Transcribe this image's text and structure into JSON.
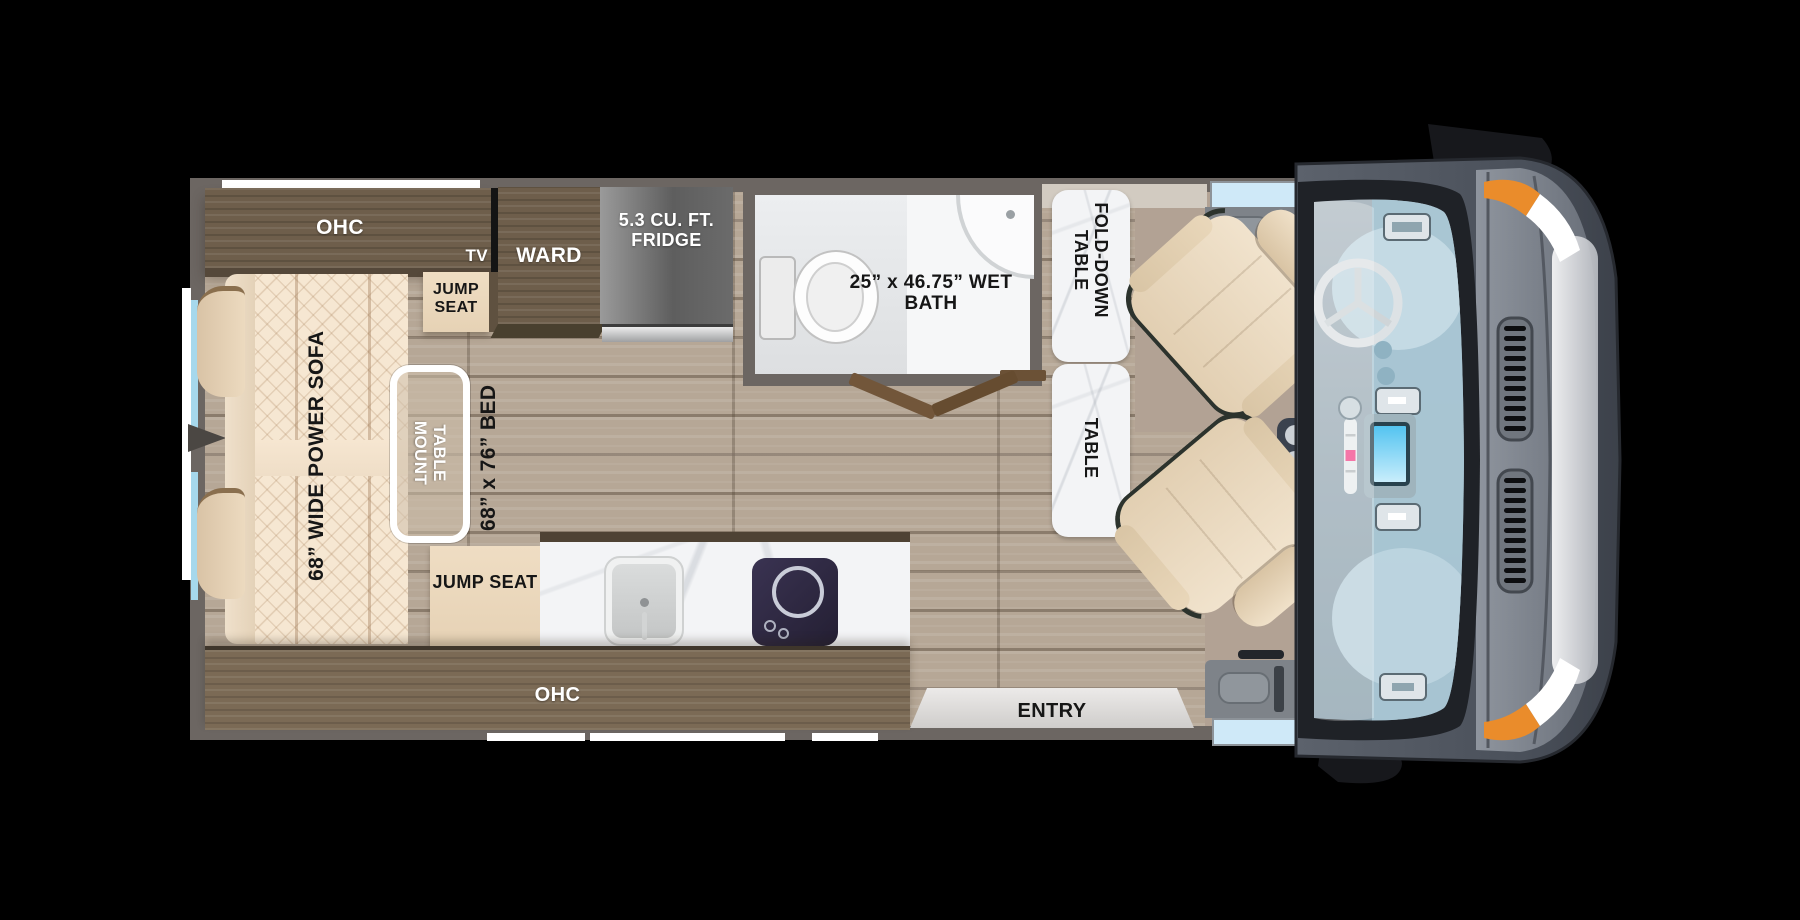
{
  "diagram": {
    "type": "rv-floor-plan",
    "labels": {
      "ohc_top": "OHC",
      "tv": "TV",
      "jump_seat_top": "JUMP SEAT",
      "ward": "WARD",
      "fridge": "5.3 CU. FT. FRIDGE",
      "wet_bath": "25” x 46.75” WET BATH",
      "fold_down_table": "FOLD-DOWN TABLE",
      "table": "TABLE",
      "power_sofa": "68” WIDE POWER SOFA",
      "table_mount": "TABLE MOUNT",
      "bed": "68” x 76” BED",
      "jump_seat_bottom": "JUMP SEAT",
      "ohc_bottom": "OHC",
      "entry": "ENTRY"
    },
    "colors": {
      "background": "#000000",
      "wall_gray": "#6c6662",
      "floor_wood": "#b6a796",
      "cab_floor_tan": "#b2a294",
      "cabinet_wood": "#6e5e4b",
      "seat_cream": "#efddc3",
      "marble_white": "#f3f4f6",
      "fridge_gray": "#7e7e7e",
      "stove_navy": "#2e2840",
      "glass_blue": "#cfe9f8",
      "van_body_gray": "#545a64",
      "accent_orange": "#ea8c2b",
      "bumper_white": "#f2f3f4"
    }
  }
}
